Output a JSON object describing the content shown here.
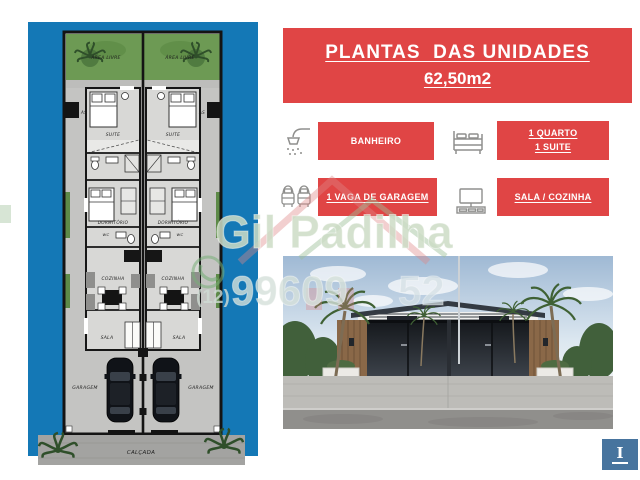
{
  "header": {
    "title": "PLANTAS  DAS UNIDADES",
    "area": "62,50m2"
  },
  "features": {
    "banheiro": {
      "icon": "shower-icon",
      "label": "BANHEIRO"
    },
    "quarto": {
      "icon": "bed-icon",
      "label_line1": "1 QUARTO",
      "label_line2": "1 SUITE"
    },
    "garagem": {
      "icon": "garage-cars-icon",
      "label": "1 VAGA DE GARAGEM"
    },
    "sala_cozinha": {
      "icon": "tv-rack-icon",
      "label": "SALA / COZINHA"
    }
  },
  "floorplan": {
    "area_livre": "ÁREA LIVRE",
    "as": "AS",
    "suite": "SUITE",
    "dormitorio": "DORMITÓRIO",
    "wc": "WC",
    "cozinha": "COZINHA",
    "sala": "SALA",
    "garagem": "GARAGEM",
    "calcada": "CALÇADA"
  },
  "watermark": {
    "name": "Gil Padilha",
    "phone_ddd": "(12)",
    "phone_part1": "99609",
    "phone_part2": "52"
  },
  "corner_badge": {
    "label": "I"
  },
  "colors": {
    "accent_red": "#e04545",
    "panel_blue": "#1478b6",
    "badge_blue": "#47749e",
    "grass_green": "#6d9a54",
    "floor_gray": "#c4c4c2",
    "watermark_green": "#ccdcc6"
  }
}
